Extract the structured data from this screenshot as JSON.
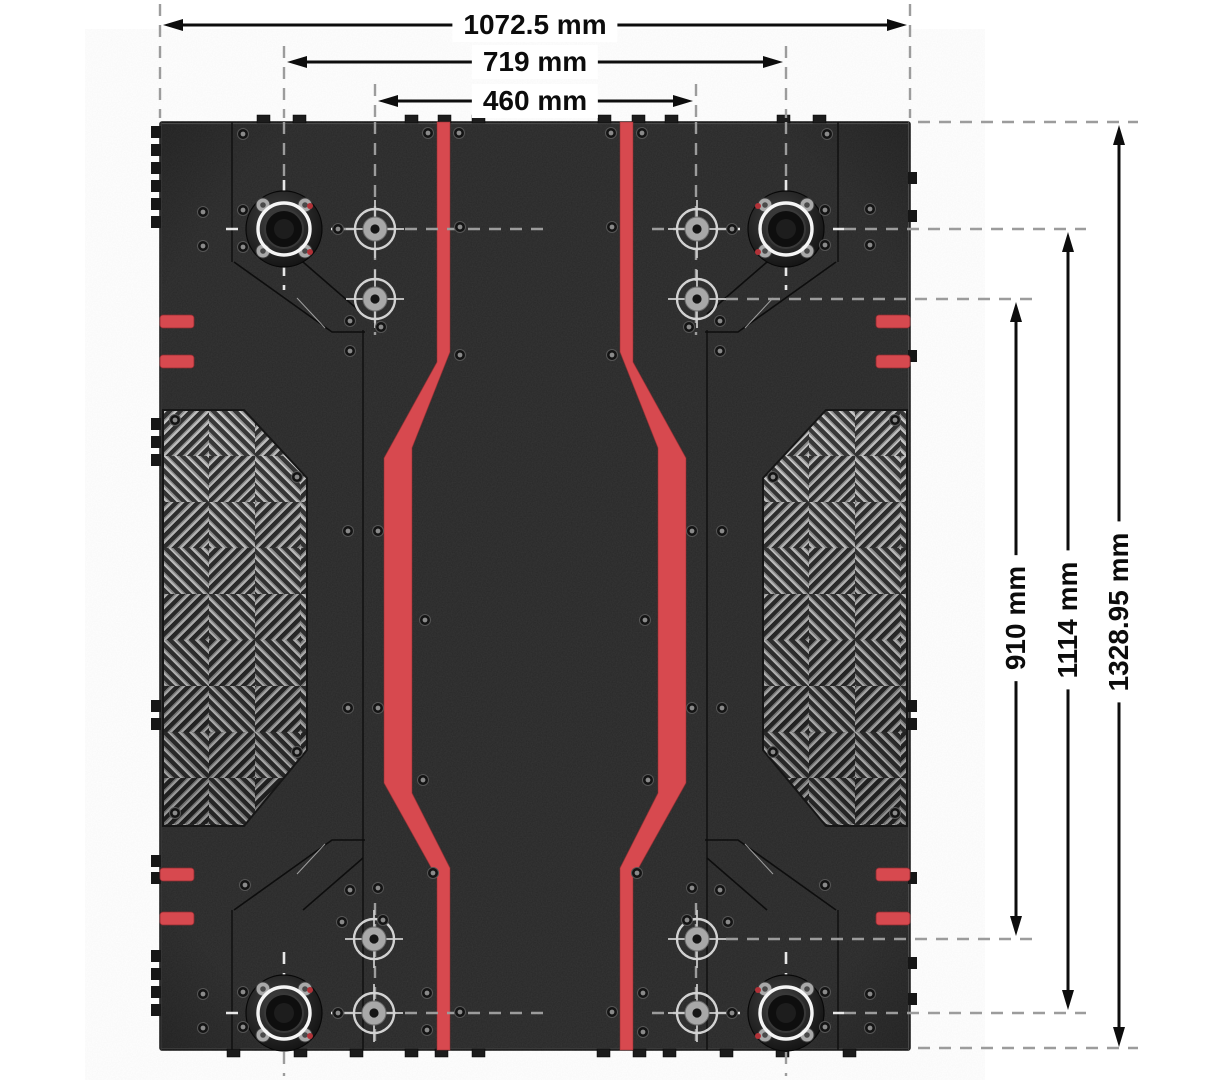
{
  "drawing": {
    "kind": "dimensioned top-view engineering drawing",
    "subject": "chassis base plate",
    "unit": "mm",
    "width_dimensions": [
      {
        "name": "overall width",
        "label": "1072.5 mm",
        "value": 1072.5
      },
      {
        "name": "hub spacing width",
        "label": "719 mm",
        "value": 719
      },
      {
        "name": "inner mount width",
        "label": "460 mm",
        "value": 460
      }
    ],
    "height_dimensions": [
      {
        "name": "inner mount height",
        "label": "910 mm",
        "value": 910
      },
      {
        "name": "hub spacing height",
        "label": "1114 mm",
        "value": 1114
      },
      {
        "name": "overall height",
        "label": "1328.95 mm",
        "value": 1328.95
      }
    ],
    "colors": {
      "accent_red": "#d7494f",
      "plate_dark": "#282828",
      "tread_plate_light": "#c2c2c2",
      "dimension_line": "#0d0d0d",
      "extension_line": "#9c9c9c",
      "background": "#ffffff"
    }
  }
}
